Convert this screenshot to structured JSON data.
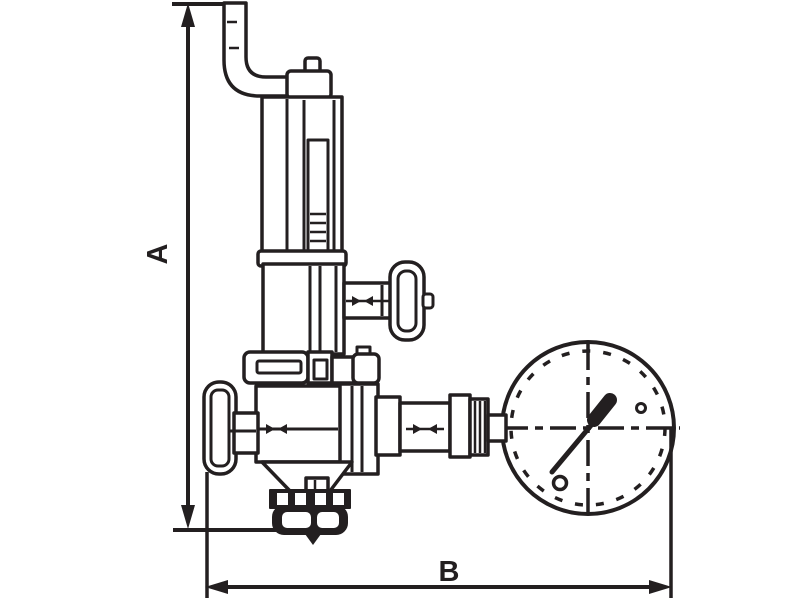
{
  "diagram": {
    "type": "technical-line-drawing",
    "subject": "pressure-reducing-valve-with-pressure-gauge",
    "labels": {
      "dimension_a": "A",
      "dimension_b": "B"
    },
    "colors": {
      "ink": "#231f20",
      "background": "#ffffff"
    }
  }
}
